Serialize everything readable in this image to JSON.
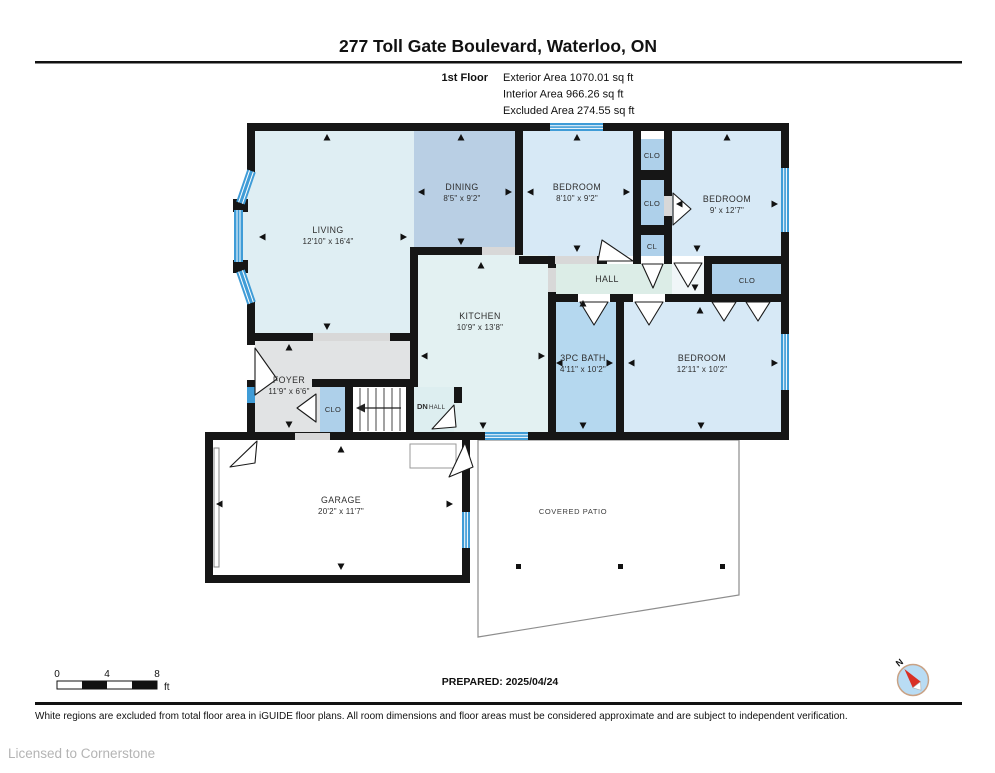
{
  "title": "277 Toll Gate Boulevard, Waterloo, ON",
  "floor_info": {
    "floor_label": "1st Floor",
    "exterior": "Exterior Area 1070.01 sq ft",
    "interior": "Interior Area 966.26 sq ft",
    "excluded": "Excluded Area 274.55 sq ft"
  },
  "rooms": {
    "living": {
      "name": "LIVING",
      "dims": "12'10\" x 16'4\""
    },
    "dining": {
      "name": "DINING",
      "dims": "8'5\" x 9'2\""
    },
    "bedroom_top": {
      "name": "BEDROOM",
      "dims": "8'10\" x 9'2\""
    },
    "bedroom_right": {
      "name": "BEDROOM",
      "dims": "9' x 12'7\""
    },
    "bedroom_bottom": {
      "name": "BEDROOM",
      "dims": "12'11\" x 10'2\""
    },
    "kitchen": {
      "name": "KITCHEN",
      "dims": "10'9\" x 13'8\""
    },
    "bath": {
      "name": "3PC BATH",
      "dims": "4'11\" x 10'2\""
    },
    "foyer": {
      "name": "FOYER",
      "dims": "11'9\" x 6'6\""
    },
    "garage": {
      "name": "GARAGE",
      "dims": "20'2\" x 11'7\""
    },
    "hall": {
      "name": "HALL"
    },
    "covered_patio": {
      "name": "COVERED PATIO"
    }
  },
  "closets": {
    "clo_top": "CLO",
    "clo_mid": "CLO",
    "cl": "CL",
    "clo_right": "CLO",
    "clo_foyer": "CLO"
  },
  "stairs": {
    "dn": "DN",
    "hall": "HALL"
  },
  "scale_bar": {
    "t0": "0",
    "t4": "4",
    "t8": "8",
    "unit": "ft"
  },
  "prepared": "PREPARED: 2025/04/24",
  "compass": {
    "north": "N"
  },
  "footer": "White regions are excluded from total floor area in iGUIDE floor plans. All room dimensions and floor areas must be considered approximate and are subject to independent verification.",
  "license": "Licensed to Cornerstone",
  "colors": {
    "wall": "#161616",
    "window_blue": "#3f9cd7",
    "room_light_blue": "#d7e9f6",
    "room_medium_blue": "#aed0ea",
    "dining_blue": "#b9cfe4",
    "bath_blue": "#b5d8ef",
    "hall_green": "#dcede7",
    "foyer_gray": "#e1e3e4",
    "compass_red": "#d93025"
  }
}
